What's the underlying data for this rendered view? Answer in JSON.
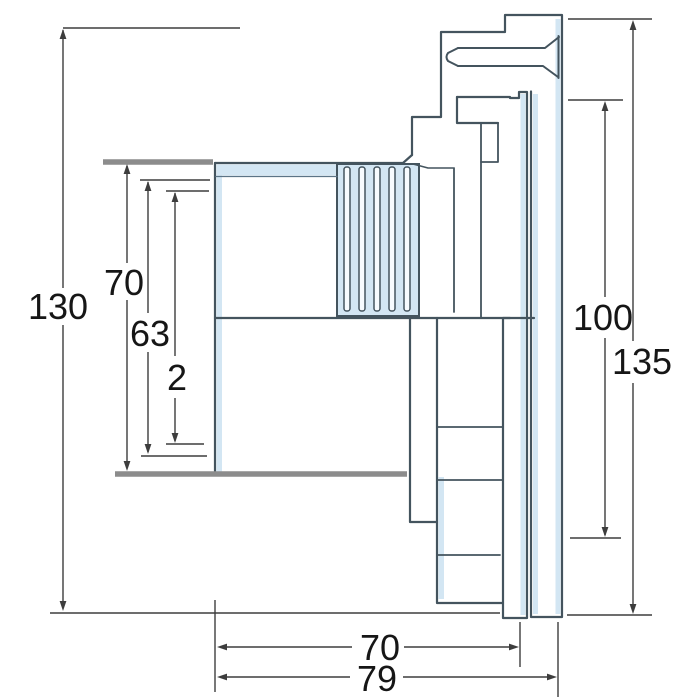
{
  "drawing": {
    "title": "Technical cross-section drawing of a threaded flange fitting",
    "unit": "mm",
    "colors": {
      "outline": "#44545e",
      "highlight_fill": "#d3e6f3",
      "groove_fill": "#f7fbfe",
      "wall_line": "#8c8c8c",
      "dimension_line": "#3d3d3d",
      "text": "#161616",
      "background": "#ffffff"
    },
    "dims": {
      "left_overall": {
        "label": "130",
        "value": 130,
        "orientation": "vertical",
        "side": "left"
      },
      "left_outer": {
        "label": "70",
        "value": 70,
        "orientation": "vertical",
        "side": "left"
      },
      "left_inner": {
        "label": "63",
        "value": 63,
        "orientation": "vertical",
        "side": "left"
      },
      "left_step": {
        "label": "2",
        "value": 2,
        "orientation": "vertical",
        "side": "left"
      },
      "right_inner": {
        "label": "100",
        "value": 100,
        "orientation": "vertical",
        "side": "right"
      },
      "right_overall": {
        "label": "135",
        "value": 135,
        "orientation": "vertical",
        "side": "right"
      },
      "bottom_depth": {
        "label": "70",
        "value": 70,
        "orientation": "horizontal",
        "side": "bottom"
      },
      "bottom_overall": {
        "label": "79",
        "value": 79,
        "orientation": "horizontal",
        "side": "bottom"
      }
    }
  }
}
